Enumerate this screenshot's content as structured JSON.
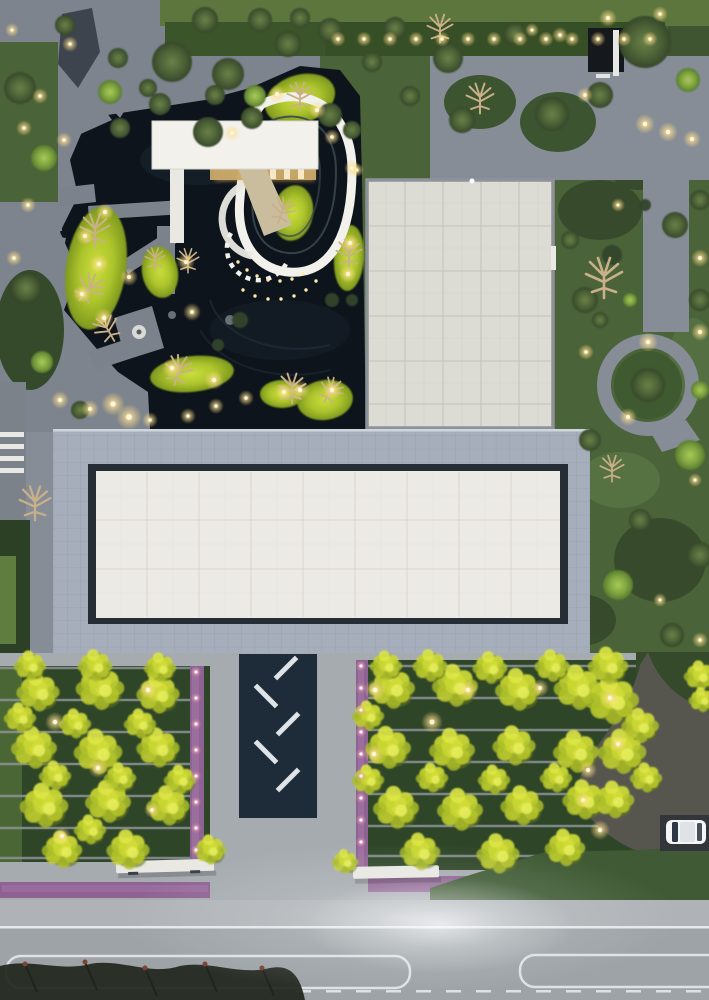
{
  "scene": {
    "type": "aerial-photo",
    "description": "Dusk aerial drone view of a landscaped courtyard complex: white flat-roof pavilion with teardrop ring path over a dark reflecting pond, two large flat-roof buildings with tiled frames, ginkgo tree bosque with hedge rows and purple gravel strips flanking a dark entry walkway, garden paths with round trees and warm path lights, driveway with one white car, and a public road at the bottom."
  },
  "palette": {
    "pond": "#0d141c",
    "plaza-top": "#868d97",
    "plaza-bottom": "#a6abb0",
    "path-gray": "#7d848e",
    "roof-white": "#f2f1ec",
    "roof-beige": "#dcdbd4",
    "roof-trim": "#8e9299",
    "frame-tile": "#a6aebb",
    "frame-line": "#939caa",
    "inset-dark": "#272d35",
    "panel-white": "#eceae4",
    "panel-line": "#d8d5cb",
    "garden-green": "#4b6339",
    "garden-dark": "#35492b",
    "hedge-dark": "#2e4527",
    "hedge-line": "#8c9297",
    "lawn-top": "#5c763e",
    "hedge-top": "#374f26",
    "walkway-navy": "#1e2c39",
    "dash-white": "#dde3e7",
    "purple": "#8e6292",
    "purple-light": "#a57aa8",
    "bench-white": "#e9e8e3",
    "road": "#9da3a7",
    "road-line": "#e6e9eb",
    "sidewalk": "#afb3b7",
    "driveway": "#56564e",
    "car-white": "#f3f5f6",
    "silhouette": "#232820",
    "glow-core": "#fff7d6",
    "bare-tan": "#c9b088"
  },
  "glows": {
    "warm": [
      [
        70,
        44,
        0.8
      ],
      [
        24,
        128,
        0.8
      ],
      [
        12,
        30,
        0.7
      ],
      [
        40,
        96,
        0.8
      ],
      [
        64,
        140,
        0.8
      ],
      [
        28,
        205,
        0.8
      ],
      [
        14,
        258,
        0.8
      ],
      [
        105,
        212,
        0.9
      ],
      [
        85,
        236,
        0.9
      ],
      [
        99,
        264,
        1
      ],
      [
        82,
        294,
        0.9
      ],
      [
        104,
        318,
        1
      ],
      [
        172,
        368,
        1
      ],
      [
        214,
        380,
        1
      ],
      [
        129,
        277,
        0.9
      ],
      [
        186,
        262,
        0.9
      ],
      [
        192,
        312,
        0.9
      ],
      [
        232,
        133,
        0.8
      ],
      [
        277,
        94,
        0.9
      ],
      [
        317,
        110,
        0.9
      ],
      [
        332,
        137,
        0.8
      ],
      [
        357,
        170,
        0.7
      ],
      [
        350,
        243,
        0.9
      ],
      [
        348,
        274,
        0.9
      ],
      [
        300,
        390,
        1
      ],
      [
        332,
        390,
        1
      ],
      [
        284,
        392,
        0.9
      ],
      [
        246,
        398,
        0.8
      ],
      [
        113,
        404,
        1.2
      ],
      [
        129,
        417,
        1.3
      ],
      [
        60,
        400,
        0.9
      ],
      [
        90,
        409,
        0.9
      ],
      [
        150,
        420,
        0.8
      ],
      [
        188,
        416,
        0.8
      ],
      [
        216,
        406,
        0.8
      ],
      [
        352,
        168,
        0.8
      ],
      [
        645,
        124,
        1
      ],
      [
        668,
        132,
        1
      ],
      [
        692,
        139,
        0.9
      ],
      [
        700,
        258,
        0.9
      ],
      [
        648,
        342,
        1
      ],
      [
        700,
        332,
        0.9
      ],
      [
        628,
        417,
        0.9
      ],
      [
        586,
        352,
        0.8
      ],
      [
        560,
        35,
        0.8
      ],
      [
        532,
        30,
        0.7
      ],
      [
        585,
        95,
        0.8
      ],
      [
        618,
        205,
        0.7
      ],
      [
        695,
        480,
        0.7
      ],
      [
        660,
        600,
        0.7
      ],
      [
        700,
        640,
        0.8
      ],
      [
        608,
        18,
        0.9
      ],
      [
        660,
        14,
        0.8
      ],
      [
        55,
        722,
        1
      ],
      [
        148,
        690,
        1
      ],
      [
        98,
        768,
        1
      ],
      [
        62,
        836,
        0.9
      ],
      [
        152,
        810,
        0.8
      ],
      [
        375,
        690,
        1.1
      ],
      [
        432,
        722,
        1.1
      ],
      [
        374,
        754,
        1
      ],
      [
        468,
        690,
        1
      ],
      [
        540,
        688,
        0.9
      ],
      [
        610,
        698,
        1
      ],
      [
        618,
        744,
        0.9
      ],
      [
        588,
        770,
        0.9
      ],
      [
        600,
        830,
        1
      ],
      [
        583,
        800,
        0.8
      ]
    ],
    "pink": [
      [
        196,
        672
      ],
      [
        196,
        698
      ],
      [
        196,
        724
      ],
      [
        196,
        750
      ],
      [
        196,
        776
      ],
      [
        196,
        802
      ],
      [
        196,
        828
      ],
      [
        196,
        850
      ],
      [
        361,
        666
      ],
      [
        361,
        688
      ],
      [
        361,
        710
      ],
      [
        361,
        732
      ],
      [
        361,
        754
      ],
      [
        361,
        776
      ],
      [
        361,
        798
      ],
      [
        361,
        820
      ],
      [
        361,
        842
      ]
    ],
    "ring_dots": [
      [
        238,
        262
      ],
      [
        247,
        270
      ],
      [
        257,
        276
      ],
      [
        268,
        280
      ],
      [
        280,
        281
      ],
      [
        292,
        279
      ],
      [
        303,
        274
      ],
      [
        243,
        290
      ],
      [
        255,
        296
      ],
      [
        268,
        299
      ],
      [
        281,
        299
      ],
      [
        294,
        296
      ],
      [
        306,
        290
      ],
      [
        316,
        281
      ]
    ]
  },
  "hedge_light_row": {
    "y": 39,
    "x0": 338,
    "x1": 652,
    "step": 26,
    "s": 0.85
  },
  "mounds": [
    [
      96,
      268,
      30,
      62,
      8
    ],
    [
      160,
      272,
      18,
      26,
      -10
    ],
    [
      192,
      374,
      42,
      18,
      -6
    ],
    [
      300,
      99,
      36,
      24,
      -18
    ],
    [
      293,
      213,
      20,
      28,
      10
    ],
    [
      349,
      258,
      15,
      33,
      4
    ],
    [
      325,
      400,
      28,
      20,
      -8
    ],
    [
      282,
      394,
      22,
      14,
      0
    ]
  ],
  "trees": {
    "olive": [
      [
        172,
        62,
        20
      ],
      [
        228,
        74,
        16
      ],
      [
        288,
        44,
        13
      ],
      [
        208,
        132,
        15
      ],
      [
        252,
        118,
        11
      ],
      [
        160,
        104,
        11
      ],
      [
        118,
        58,
        10
      ],
      [
        448,
        58,
        15
      ],
      [
        515,
        34,
        11
      ],
      [
        645,
        42,
        26
      ],
      [
        600,
        95,
        13
      ],
      [
        552,
        114,
        17
      ],
      [
        462,
        120,
        13
      ],
      [
        410,
        96,
        10
      ],
      [
        372,
        62,
        10
      ],
      [
        330,
        30,
        12
      ],
      [
        395,
        28,
        11
      ],
      [
        260,
        20,
        12
      ],
      [
        300,
        18,
        10
      ],
      [
        205,
        20,
        13
      ],
      [
        65,
        25,
        10
      ],
      [
        20,
        88,
        16
      ],
      [
        26,
        288,
        15
      ],
      [
        80,
        410,
        9
      ],
      [
        120,
        128,
        10
      ],
      [
        148,
        88,
        9
      ],
      [
        215,
        95,
        10
      ],
      [
        330,
        115,
        12
      ],
      [
        352,
        130,
        9
      ],
      [
        585,
        300,
        13
      ],
      [
        675,
        225,
        13
      ],
      [
        700,
        300,
        11
      ],
      [
        590,
        440,
        11
      ],
      [
        640,
        520,
        11
      ],
      [
        700,
        555,
        13
      ],
      [
        672,
        635,
        12
      ],
      [
        648,
        385,
        17
      ],
      [
        700,
        200,
        10
      ],
      [
        570,
        240,
        9
      ],
      [
        600,
        320,
        8
      ]
    ],
    "bright": [
      [
        688,
        80,
        12
      ],
      [
        44,
        158,
        13
      ],
      [
        42,
        362,
        11
      ],
      [
        110,
        92,
        12
      ],
      [
        255,
        96,
        11
      ],
      [
        700,
        390,
        9
      ],
      [
        690,
        455,
        15
      ],
      [
        618,
        585,
        15
      ],
      [
        630,
        300,
        7
      ]
    ],
    "bare": [
      [
        95,
        232,
        1.6,
        0
      ],
      [
        88,
        290,
        1.5,
        40
      ],
      [
        108,
        330,
        1.4,
        -30
      ],
      [
        178,
        372,
        1.5,
        15
      ],
      [
        300,
        98,
        1.4,
        0
      ],
      [
        282,
        212,
        1.3,
        20
      ],
      [
        292,
        390,
        1.5,
        0
      ],
      [
        330,
        392,
        1.3,
        30
      ],
      [
        188,
        262,
        1.2,
        0
      ],
      [
        440,
        30,
        1.4,
        0
      ],
      [
        480,
        100,
        1.5,
        0
      ],
      [
        604,
        280,
        2.0,
        0
      ],
      [
        612,
        470,
        1.3,
        0
      ],
      [
        35,
        505,
        1.7,
        0
      ],
      [
        155,
        260,
        1.1,
        0
      ],
      [
        349,
        255,
        1.4,
        0
      ]
    ],
    "bushes": [
      [
        240,
        320,
        8
      ],
      [
        218,
        345,
        6
      ],
      [
        332,
        300,
        7
      ],
      [
        352,
        300,
        6
      ],
      [
        470,
        885,
        10
      ],
      [
        515,
        878,
        8
      ],
      [
        560,
        872,
        9
      ],
      [
        612,
        255,
        10
      ],
      [
        645,
        205,
        6
      ]
    ]
  },
  "ginkgo": [
    [
      38,
      692,
      16
    ],
    [
      100,
      688,
      18
    ],
    [
      158,
      694,
      16
    ],
    [
      34,
      748,
      17
    ],
    [
      98,
      752,
      18
    ],
    [
      158,
      748,
      16
    ],
    [
      44,
      806,
      18
    ],
    [
      108,
      802,
      17
    ],
    [
      168,
      806,
      16
    ],
    [
      62,
      850,
      15
    ],
    [
      128,
      850,
      16
    ],
    [
      20,
      718,
      12
    ],
    [
      75,
      724,
      12
    ],
    [
      140,
      724,
      12
    ],
    [
      55,
      776,
      12
    ],
    [
      120,
      778,
      12
    ],
    [
      180,
      780,
      12
    ],
    [
      90,
      830,
      12
    ],
    [
      30,
      666,
      12
    ],
    [
      95,
      666,
      13
    ],
    [
      160,
      668,
      12
    ],
    [
      210,
      850,
      12
    ],
    [
      392,
      688,
      17
    ],
    [
      455,
      686,
      17
    ],
    [
      518,
      690,
      17
    ],
    [
      578,
      688,
      18
    ],
    [
      388,
      748,
      17
    ],
    [
      452,
      750,
      17
    ],
    [
      514,
      746,
      16
    ],
    [
      576,
      752,
      17
    ],
    [
      396,
      808,
      17
    ],
    [
      460,
      810,
      17
    ],
    [
      522,
      806,
      16
    ],
    [
      584,
      800,
      16
    ],
    [
      420,
      852,
      15
    ],
    [
      498,
      854,
      16
    ],
    [
      565,
      848,
      15
    ],
    [
      612,
      700,
      20
    ],
    [
      622,
      752,
      18
    ],
    [
      614,
      800,
      15
    ],
    [
      430,
      666,
      13
    ],
    [
      490,
      668,
      13
    ],
    [
      552,
      666,
      13
    ],
    [
      608,
      666,
      15
    ],
    [
      700,
      676,
      12
    ],
    [
      640,
      726,
      14
    ],
    [
      646,
      778,
      12
    ],
    [
      368,
      716,
      12
    ],
    [
      368,
      780,
      12
    ],
    [
      432,
      778,
      12
    ],
    [
      494,
      780,
      12
    ],
    [
      556,
      778,
      12
    ],
    [
      386,
      666,
      12
    ],
    [
      702,
      700,
      10
    ],
    [
      345,
      862,
      10
    ]
  ],
  "hedge_rows": [
    {
      "x0": 0,
      "x1": 190,
      "ys": [
        668,
        700,
        732,
        764,
        796,
        828,
        858
      ]
    },
    {
      "x0": 368,
      "x1": 636,
      "ys": [
        666,
        698,
        730,
        762,
        794,
        826,
        856
      ]
    }
  ],
  "walkway_dashes": [
    [
      286,
      668,
      -45
    ],
    [
      266,
      696,
      45
    ],
    [
      288,
      724,
      -45
    ],
    [
      266,
      752,
      45
    ],
    [
      288,
      780,
      -45
    ]
  ],
  "vbuilding_grid": {
    "v": {
      "xs": [
        405,
        443,
        481,
        519
      ],
      "y0": 182,
      "y1": 426
    },
    "h": {
      "ys": [
        226,
        271,
        316,
        361,
        404
      ],
      "x0": 369,
      "x1": 551
    },
    "v2": {
      "xs": [
        386,
        424,
        462,
        500,
        538
      ],
      "y0": 182,
      "y1": 426
    },
    "h2": {
      "ys": [
        203,
        248,
        293,
        338,
        383
      ],
      "x0": 369,
      "x1": 551
    }
  },
  "panel_grid": {
    "v": {
      "xs": [
        147,
        199,
        251,
        303,
        355,
        407,
        459,
        511
      ],
      "y0": 472,
      "y1": 617
    },
    "h": {
      "ys": [
        520,
        569
      ],
      "x0": 96,
      "x1": 560
    },
    "v2": {
      "xs": [
        121,
        173,
        225,
        277,
        329,
        381,
        433,
        485,
        537
      ],
      "y0": 472,
      "y1": 617
    },
    "h2": {
      "ys": [
        496,
        544,
        593
      ],
      "x0": 96,
      "x1": 560
    }
  },
  "road_dashes": {
    "y": 990,
    "x0": 296,
    "x1": 705,
    "len": 15,
    "gap": 15
  },
  "silhouette_tips": [
    [
      25,
      964
    ],
    [
      85,
      962
    ],
    [
      145,
      968
    ],
    [
      205,
      964
    ],
    [
      262,
      968
    ]
  ]
}
